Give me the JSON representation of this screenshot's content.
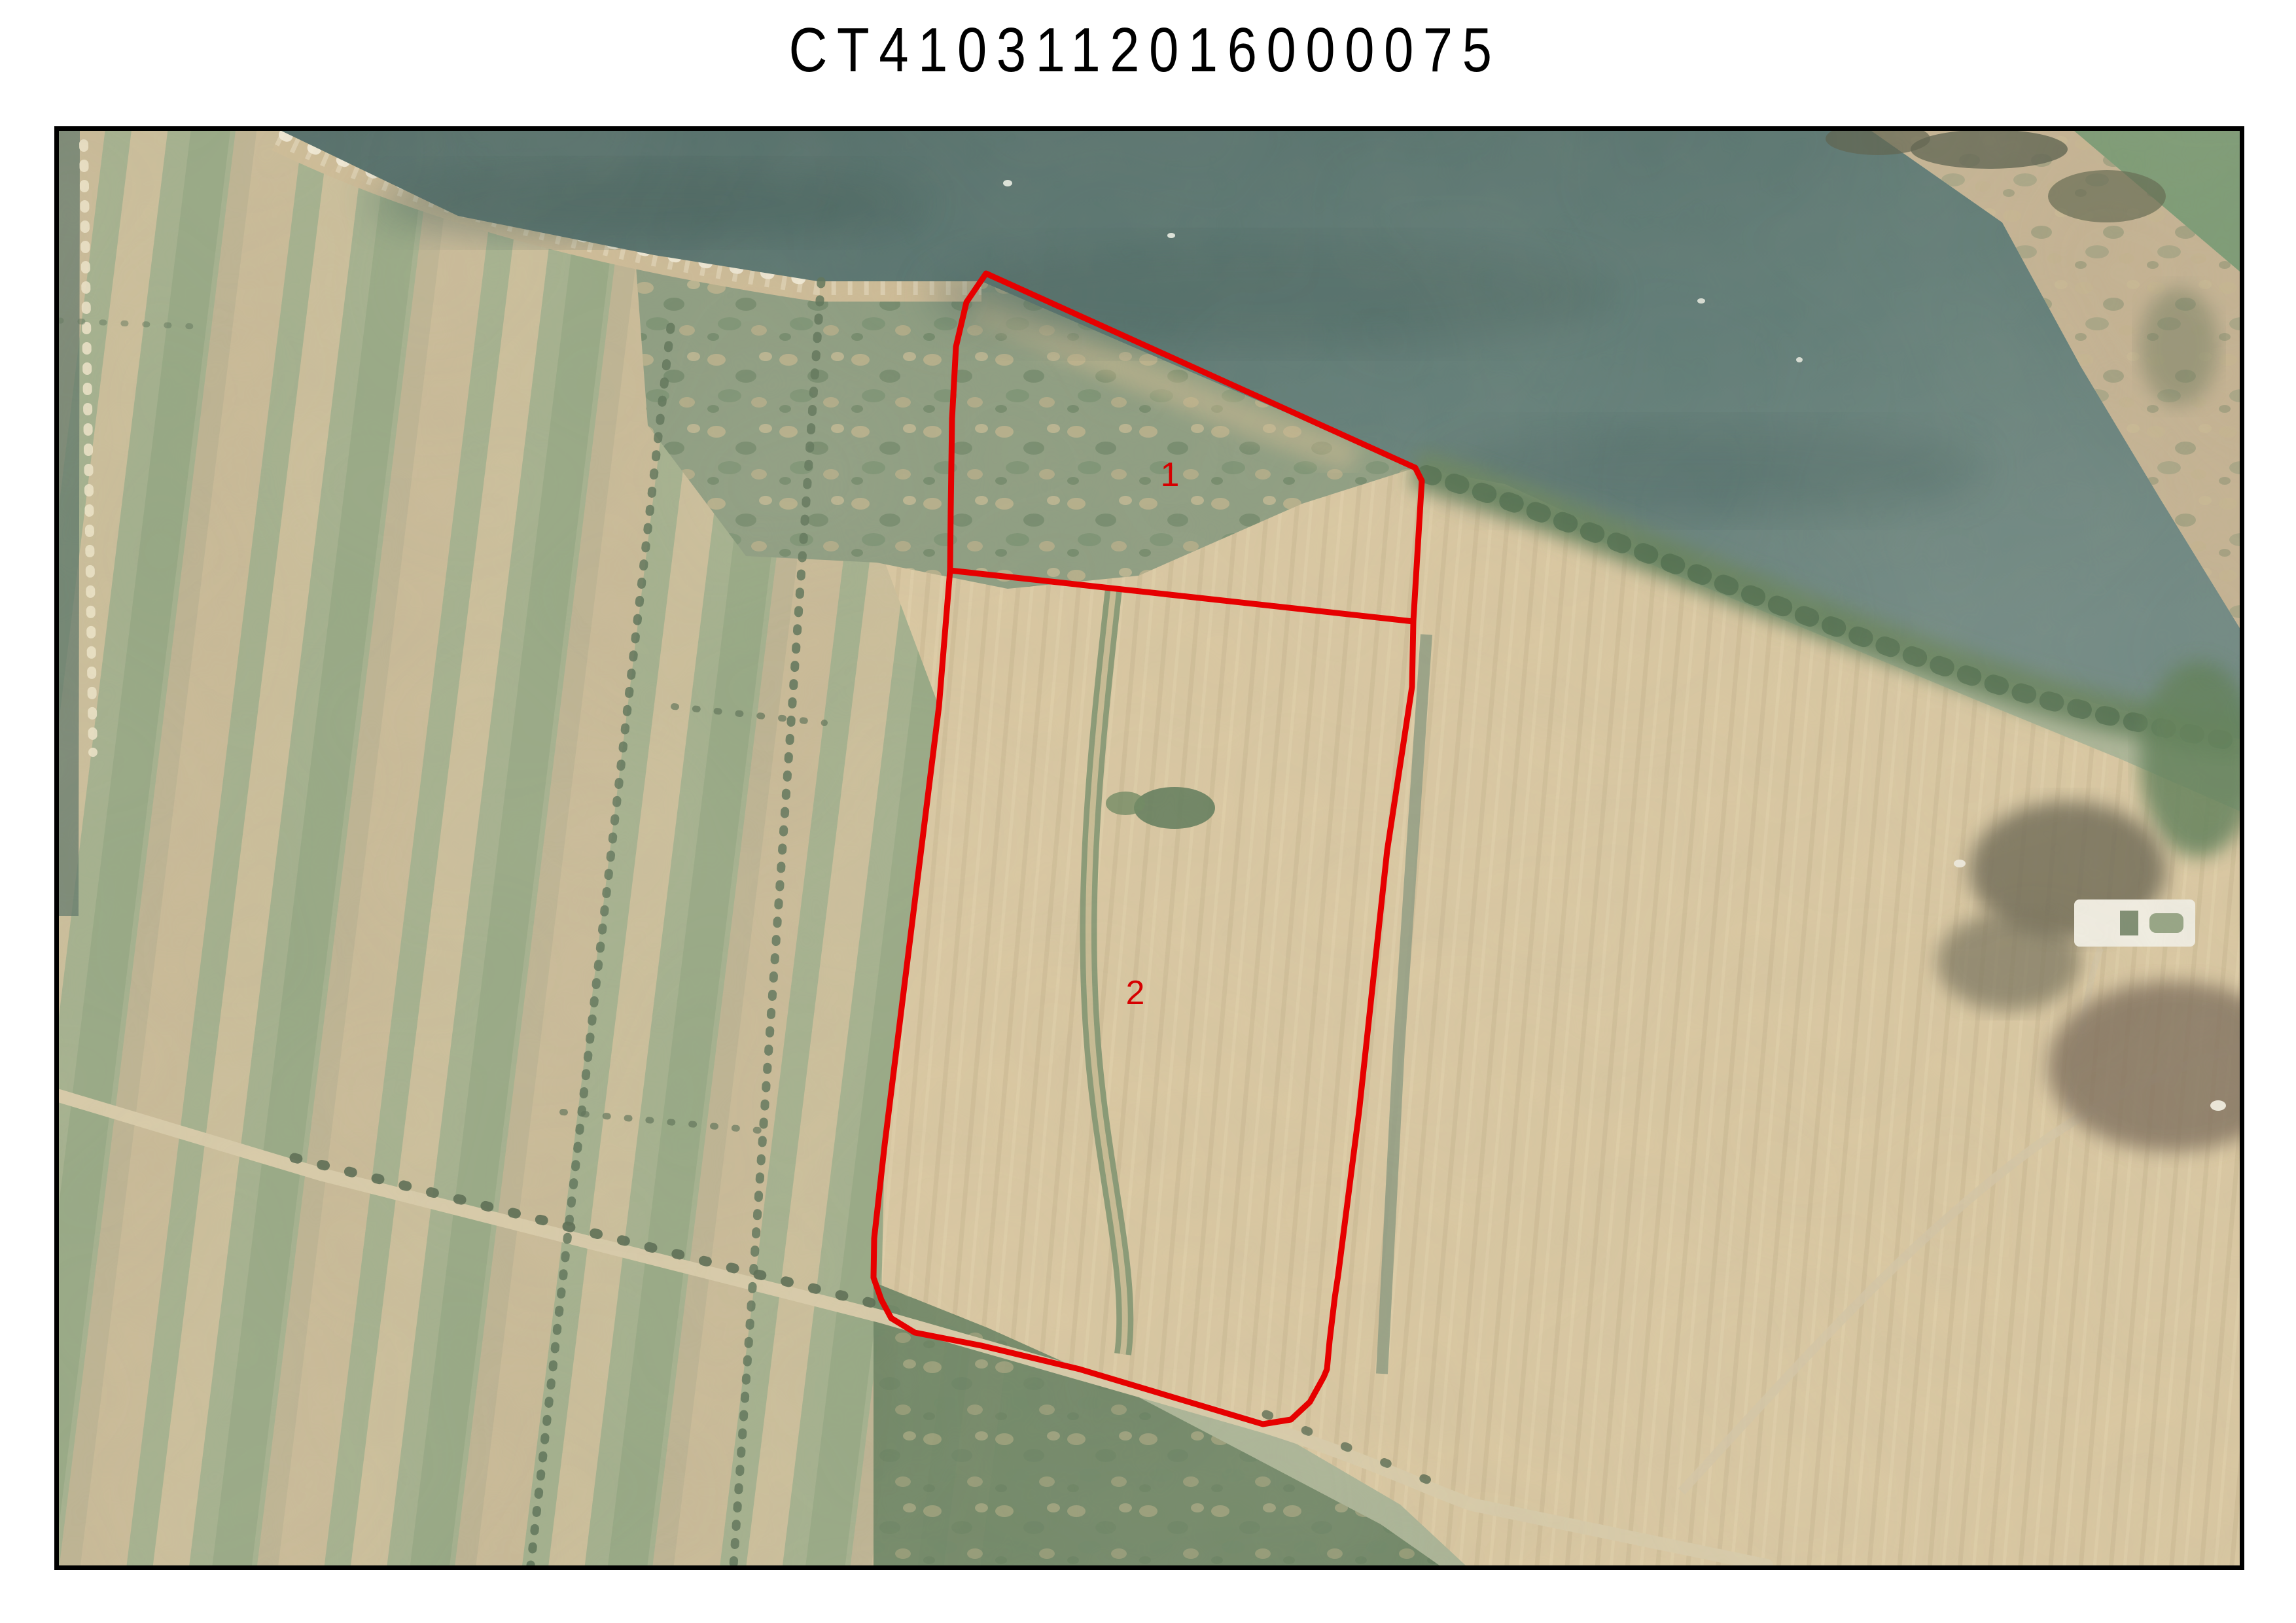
{
  "header": {
    "title": "CT4103112016000075"
  },
  "map": {
    "border_color": "#000000",
    "overlay_color": "#e60000",
    "label_color": "#d60000",
    "water_color": "#5d7a75",
    "field_tan_color": "#d9c7a1",
    "field_green_color": "#a3b08d",
    "parcels": [
      {
        "label": "1"
      },
      {
        "label": "2"
      }
    ]
  }
}
